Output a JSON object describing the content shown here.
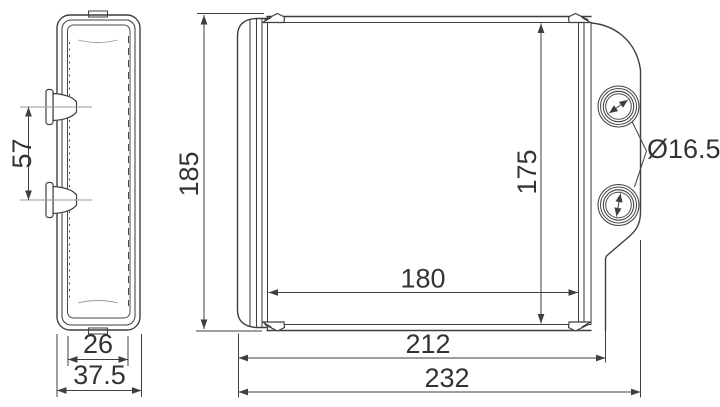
{
  "page": {
    "background": "#ffffff"
  },
  "drawing": {
    "line_color": "#3f3f3f",
    "text_color": "#333333",
    "views": {
      "side": {
        "dims": {
          "pipe_spacing": "57",
          "inner_depth": "26",
          "overall_depth": "37.5"
        }
      },
      "front": {
        "dims": {
          "overall_height": "185",
          "core_height": "175",
          "core_width": "180",
          "body_width": "212",
          "overall_width": "232",
          "port_diameter": "Ø16.5"
        }
      }
    }
  }
}
